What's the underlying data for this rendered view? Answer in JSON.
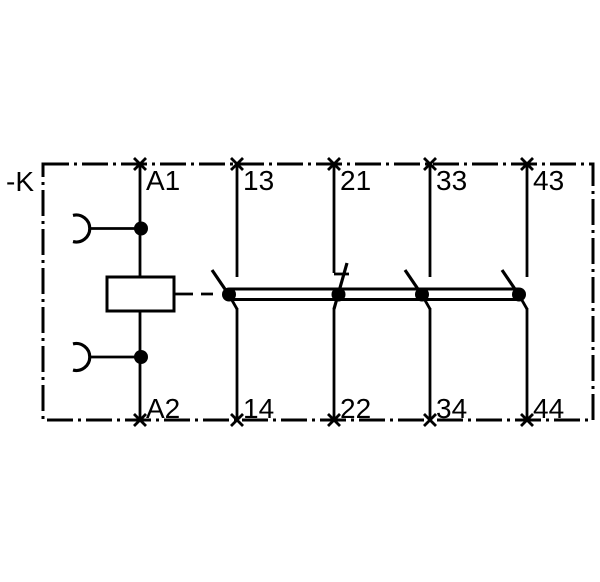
{
  "schematic": {
    "kind": "contactor-relay-circuit-diagram",
    "device_label": "-K",
    "colors": {
      "line": "#000000",
      "background": "#ffffff"
    },
    "coil": {
      "top_terminal": "A1",
      "bottom_terminal": "A2",
      "symbol": "rectangle-coil",
      "plug_connections": 2
    },
    "contacts": [
      {
        "type": "NO",
        "top_terminal": "13",
        "bottom_terminal": "14"
      },
      {
        "type": "NC",
        "top_terminal": "21",
        "bottom_terminal": "22"
      },
      {
        "type": "NO",
        "top_terminal": "33",
        "bottom_terminal": "34"
      },
      {
        "type": "NO",
        "top_terminal": "43",
        "bottom_terminal": "44"
      }
    ],
    "mechanical_link": "crossbar-connecting-all-contacts-to-coil"
  }
}
